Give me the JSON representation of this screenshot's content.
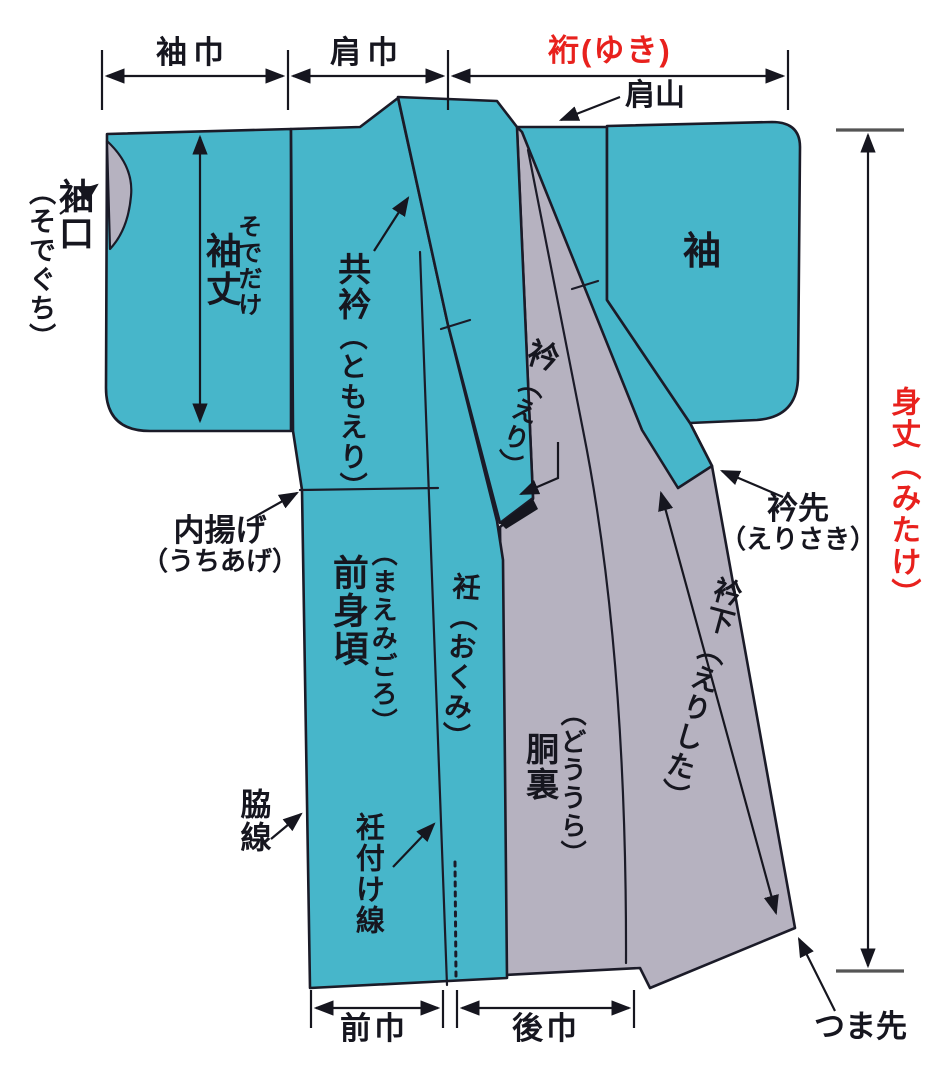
{
  "diagram_title": "kimono parts and measurements diagram",
  "colors": {
    "fabric": "#47b6ca",
    "lining": "#b6b2c0",
    "outline": "#1b1b28",
    "accent_red": "#e8211d"
  },
  "measurements": {
    "sode_haba": "袖巾",
    "kata_haba": "肩巾",
    "yuki": "裄(ゆき)",
    "mitake": "身丈（みたけ）",
    "eri_shita": "衿下（えりした）",
    "sode_take_reading": "そでだけ",
    "sode_take": "袖丈",
    "mae_haba": "前巾",
    "ushiro_haba": "後巾"
  },
  "labels": {
    "kata_yama": "肩山",
    "sode": "袖",
    "sode_guchi_main": "袖口",
    "sode_guchi_reading": "（そでぐち）",
    "tomo_eri_main": "共衿",
    "tomo_eri_reading": "（ともえり）",
    "eri_main": "衿",
    "eri_reading": "（えり）",
    "uchi_age_main": "内揚げ",
    "uchi_age_reading": "（うちあげ）",
    "eri_saki_main": "衿先",
    "eri_saki_reading": "（えりさき）",
    "mae_migoro_reading": "（まえみごろ）",
    "mae_migoro_main": "前身頃",
    "okumi": "衽（おくみ）",
    "do_ura_reading": "（どううら）",
    "do_ura_main": "胴裏",
    "waki_sen": "脇線",
    "okumi_tsuke_sen": "衽付け線",
    "tsuma_saki": "つま先"
  }
}
